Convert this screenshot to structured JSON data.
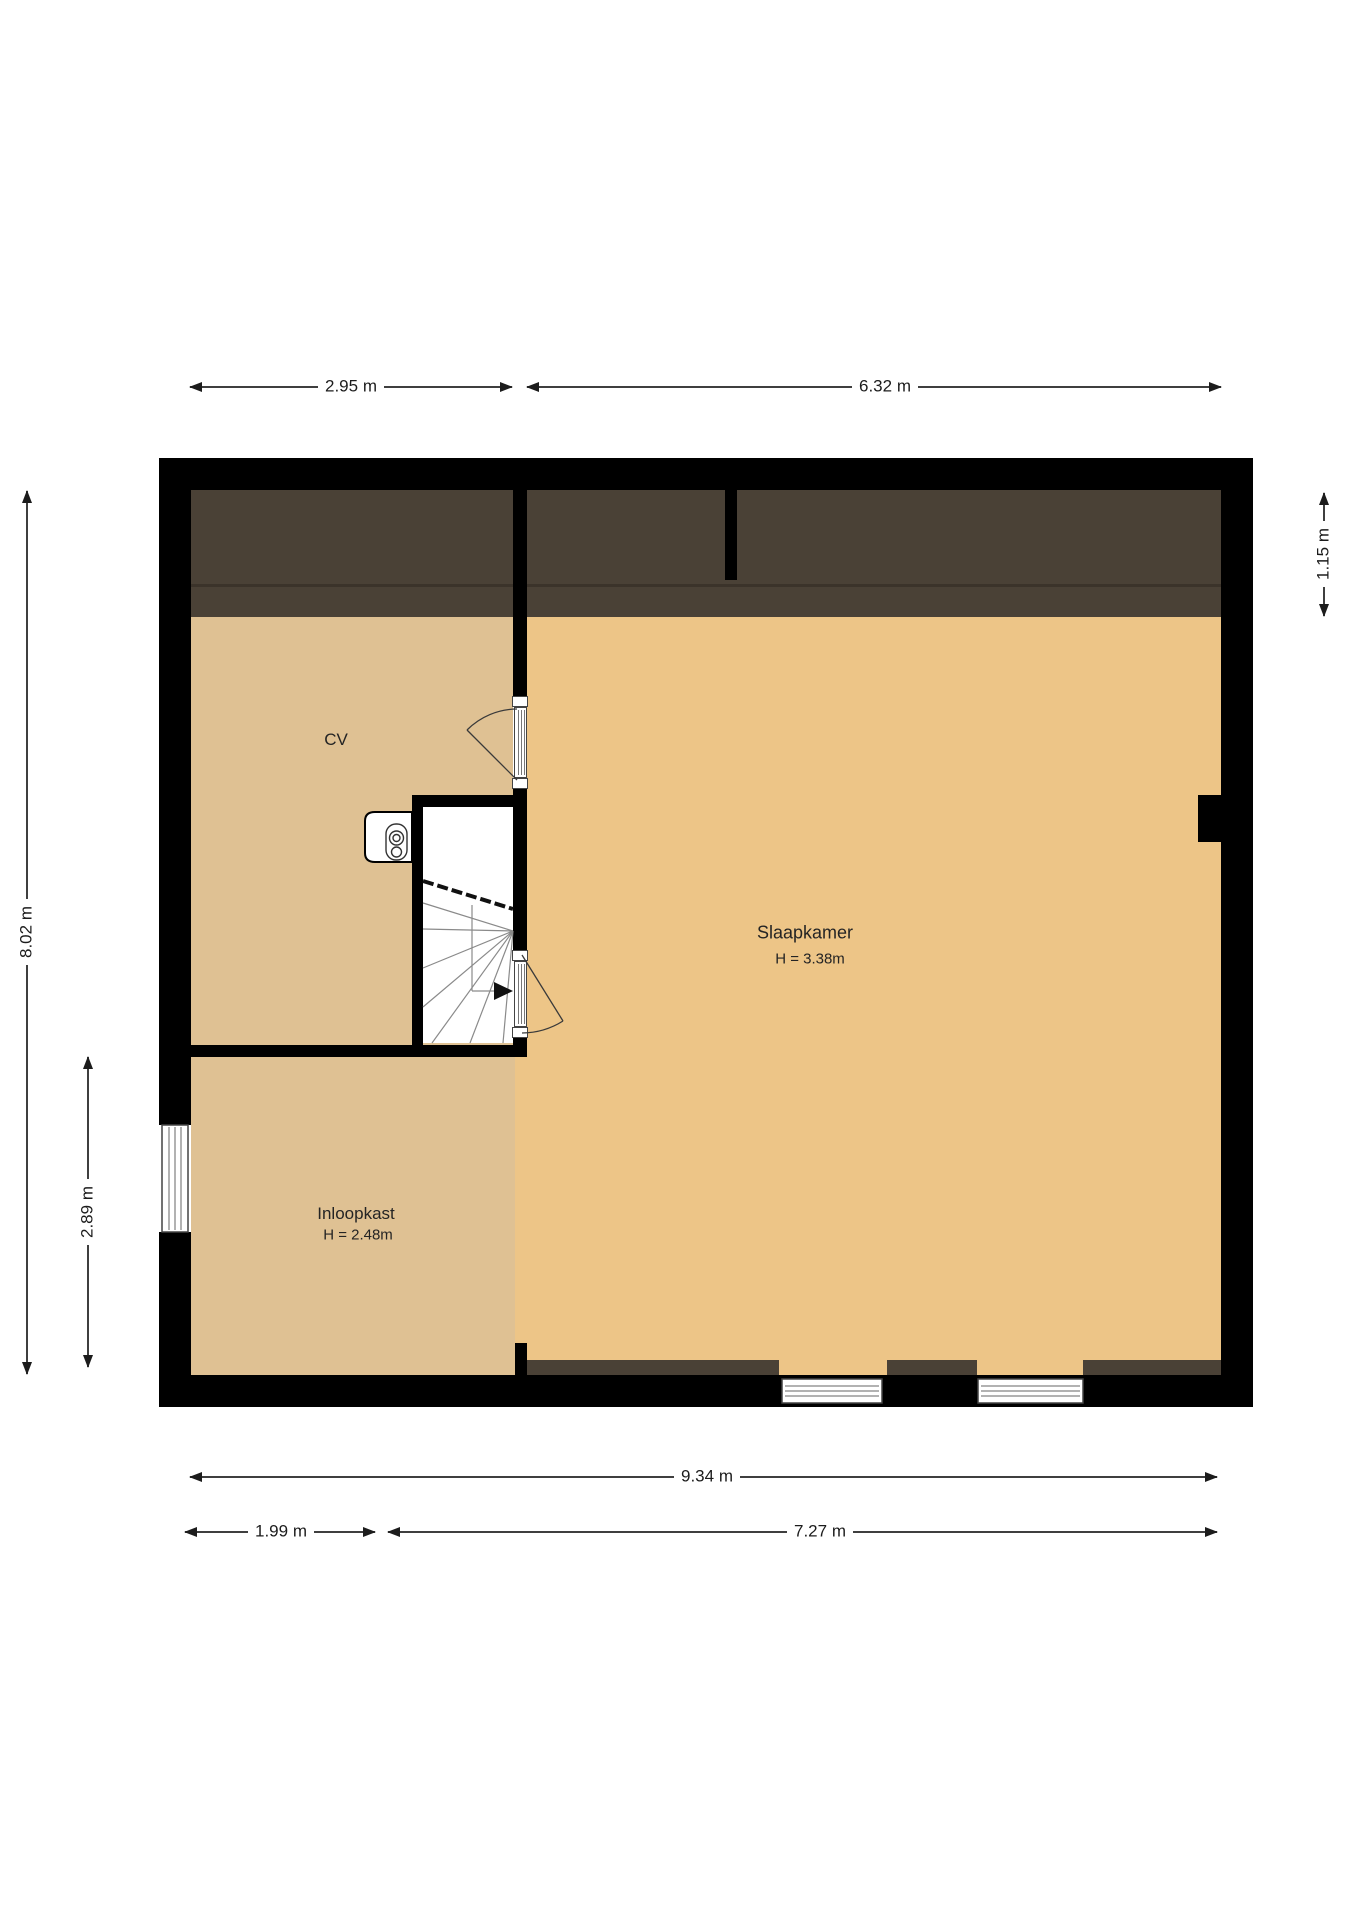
{
  "plan": {
    "title": "Verdieping plattegrond",
    "rooms": [
      {
        "name": "CV",
        "height_label": ""
      },
      {
        "name": "Slaapkamer",
        "height_label": "H = 3.38m"
      },
      {
        "name": "Inloopkast",
        "height_label": "H = 2.48m"
      }
    ],
    "dimensions": {
      "top_left": "2.95 m",
      "top_right": "6.32 m",
      "right": "1.15 m",
      "left_outer": "8.02 m",
      "left_inner": "2.89 m",
      "bottom_total": "9.34 m",
      "bottom_left": "1.99 m",
      "bottom_right": "7.27 m"
    },
    "colors": {
      "wall": "#000000",
      "floor_left": "#dfc193",
      "floor_main": "#edc587",
      "roof_zone": "#4a4136",
      "roof_line": "#3b332a",
      "dim_line": "#3f3f3f",
      "text": "#1c1c1c"
    }
  }
}
